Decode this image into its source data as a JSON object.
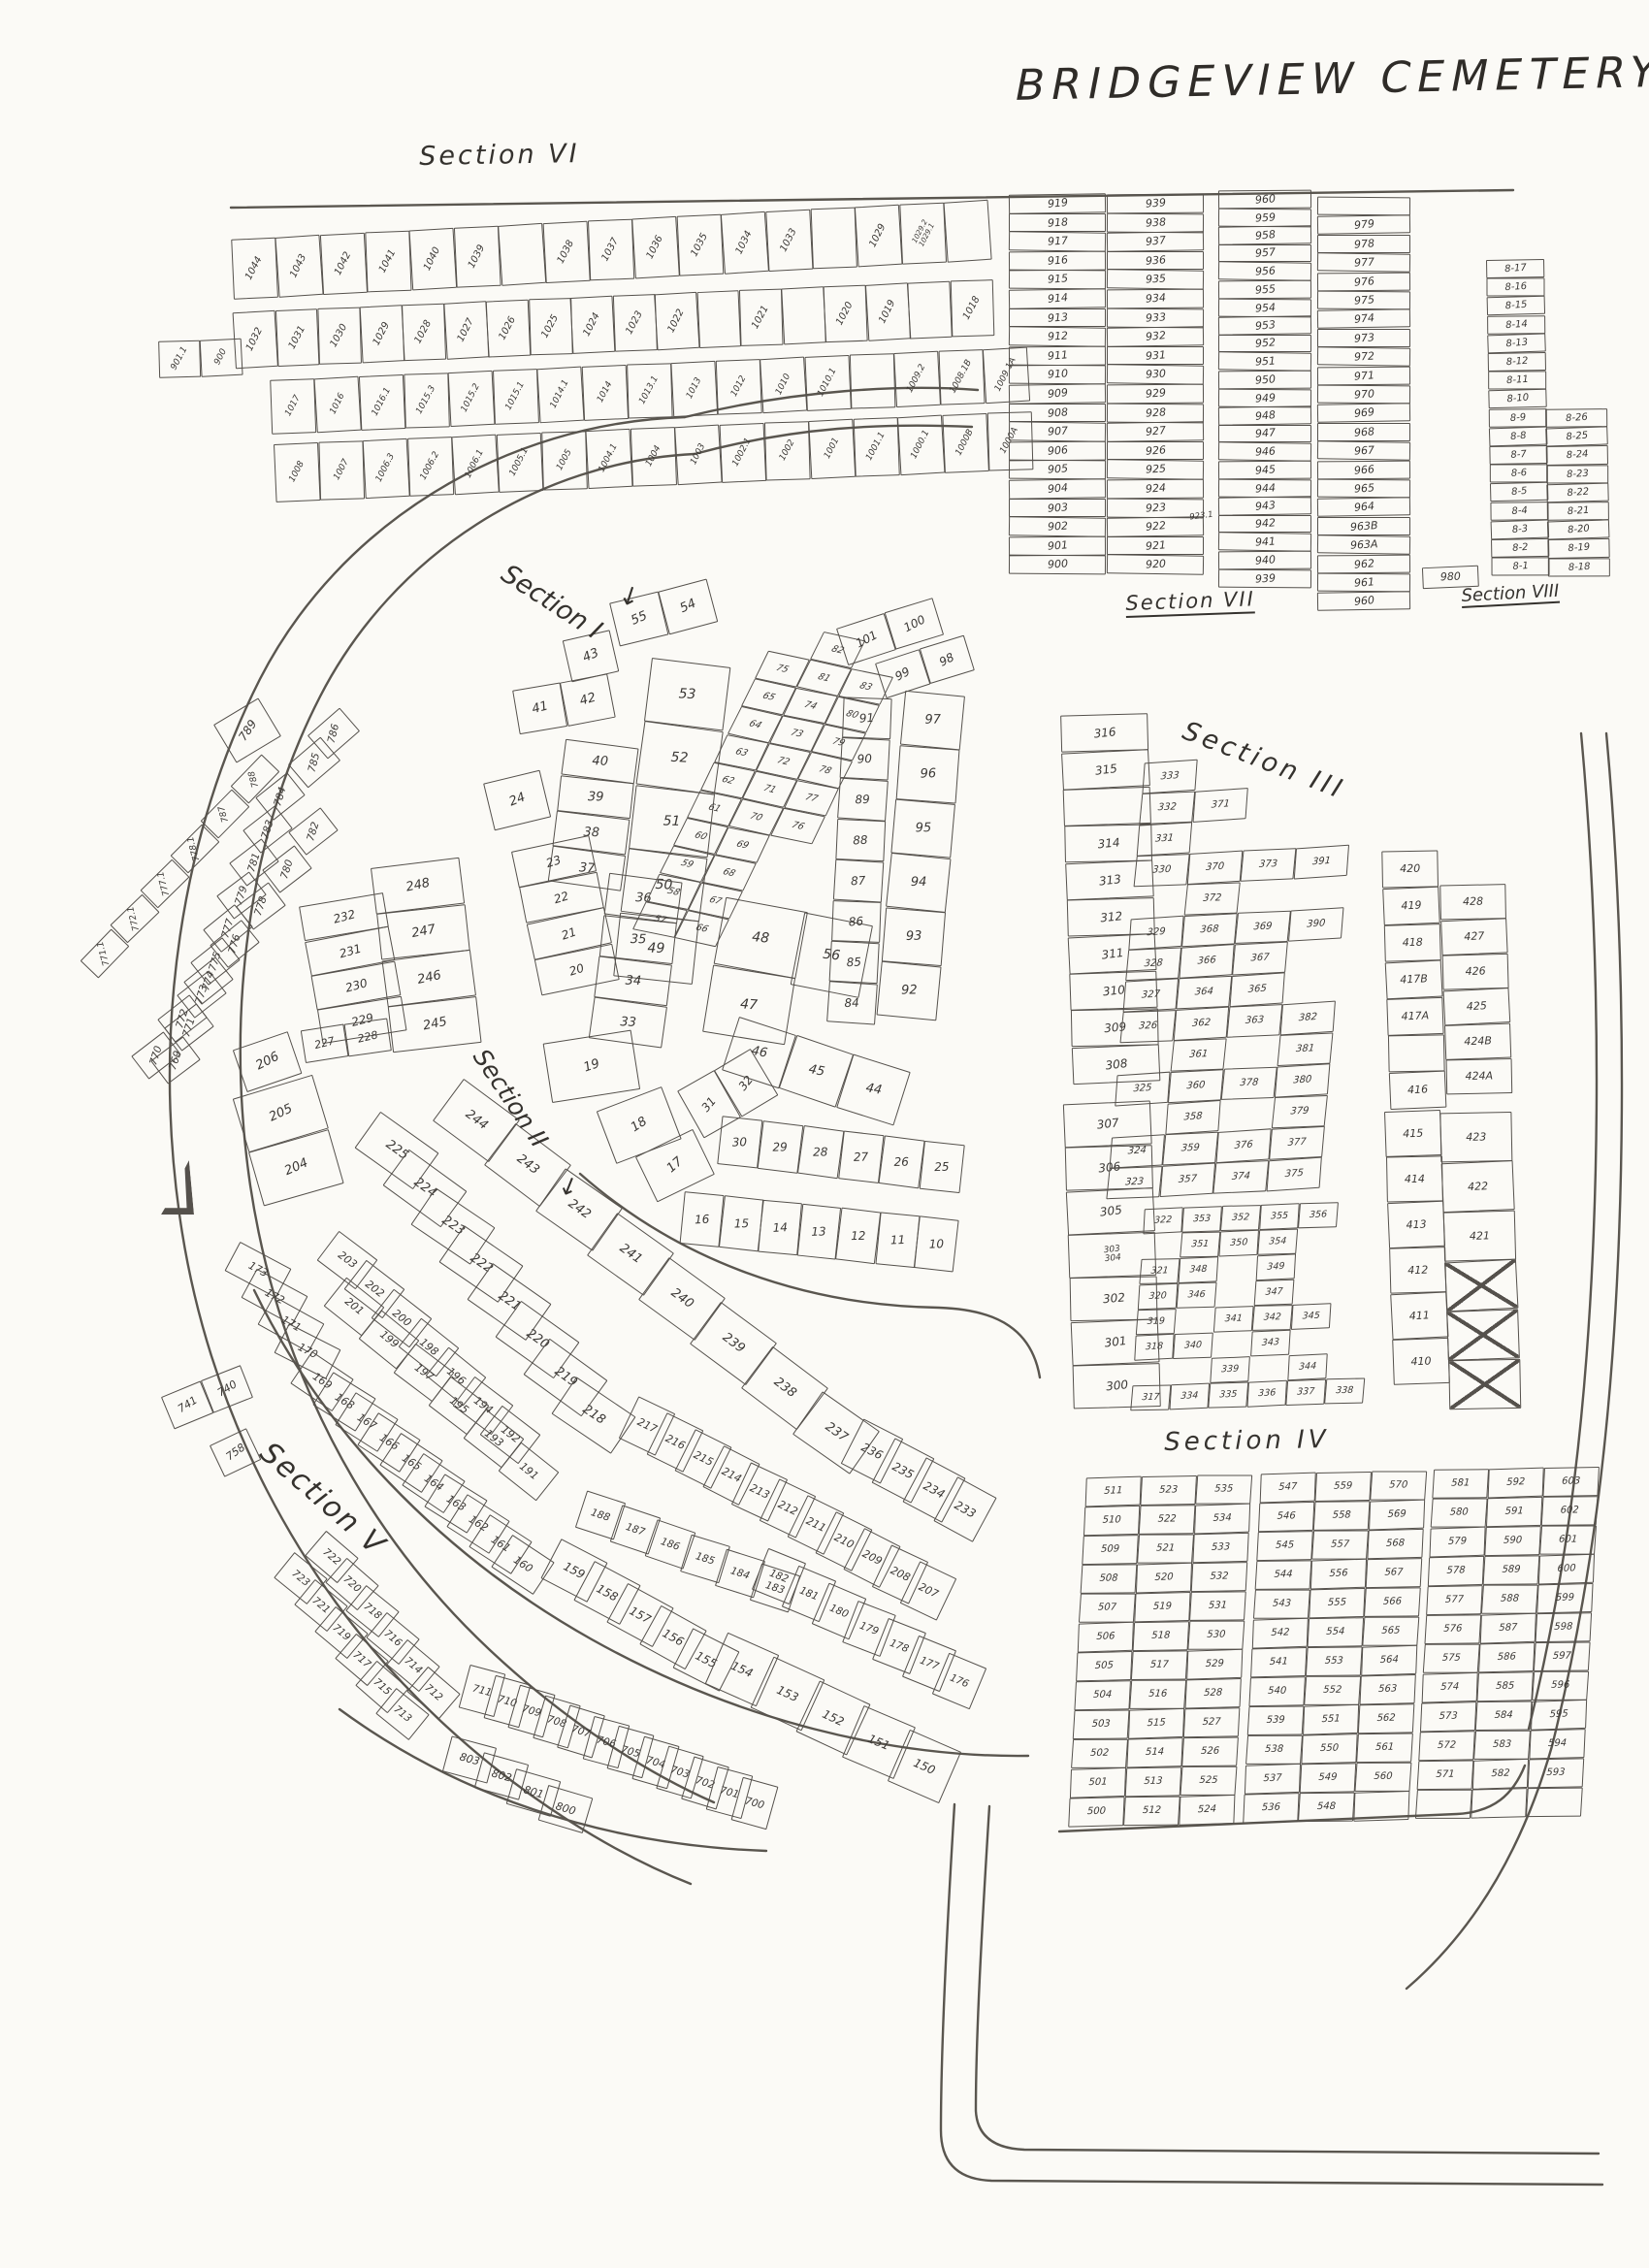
{
  "title": "BRIDGEVIEW CEMETERY",
  "icons": {
    "down_arrow": "↓"
  },
  "section_labels": {
    "s1": "Section I",
    "s2": "Section II",
    "s3": "Section III",
    "s4": "Section IV",
    "s5": "Section V",
    "s6": "Section VI",
    "s7": "Section VII",
    "s8": "Section VIII"
  },
  "plot_groups": {
    "s6r1": [
      "1044",
      "1043",
      "1042",
      "1041",
      "1040",
      "1039",
      "",
      "1038",
      "1037",
      "1036",
      "1035",
      "1034",
      "1033",
      "",
      "1029",
      "1029.2|1029.1",
      ""
    ],
    "s6r2": [
      "1032",
      "1031",
      "1030",
      "1029",
      "1028",
      "1027",
      "1026",
      "1025",
      "1024",
      "1023",
      "1022",
      "",
      "1021",
      "",
      "1020",
      "1019",
      "",
      "1018"
    ],
    "s6r3": [
      "1017",
      "1016",
      "1016.1",
      "1015.3",
      "1015.2",
      "1015.1",
      "1014.1",
      "1014",
      "1013.1",
      "1013",
      "1012",
      "1010",
      "1010.1",
      "",
      "1009.2",
      "1008.1B",
      "1009.1A"
    ],
    "s6r4": [
      "1008",
      "1007",
      "1006.3",
      "1006.2",
      "1006.1",
      "1005.1",
      "1005",
      "1004.1",
      "1004",
      "1003",
      "1002.1",
      "1002",
      "1001",
      "1001.1",
      "1000.1",
      "1000B",
      "1000A"
    ],
    "s6box": [
      "901.1",
      "900"
    ],
    "s7c1": [
      "919",
      "918",
      "917",
      "916",
      "915",
      "914",
      "913",
      "912",
      "911",
      "910",
      "909",
      "908",
      "907",
      "906",
      "905",
      "904",
      "903",
      "902",
      "901",
      "900"
    ],
    "s7c2": [
      "939",
      "938",
      "937",
      "936",
      "935",
      "934",
      "933",
      "932",
      "931",
      "930",
      "929",
      "928",
      "927",
      "926",
      "925",
      "924",
      "923",
      "922",
      "921",
      "920"
    ],
    "s7c3": [
      "960",
      "959",
      "958",
      "957",
      "956",
      "955",
      "954",
      "953",
      "952",
      "951",
      "950",
      "949",
      "948",
      "947",
      "946",
      "945",
      "944",
      "943",
      "942",
      "941",
      "940",
      "939"
    ],
    "s7c4": [
      "",
      "979",
      "978",
      "977",
      "976",
      "975",
      "974",
      "973",
      "972",
      "971",
      "970",
      "969",
      "968",
      "967",
      "966",
      "965",
      "964",
      "963B",
      "963A",
      "962",
      "961",
      "960"
    ],
    "s7extra": [
      "980"
    ],
    "s7x9231": [
      "923.1"
    ],
    "s8c1": [
      "8-17",
      "8-16",
      "8-15",
      "8-14",
      "8-13",
      "8-12",
      "8-11",
      "8-10",
      "8-9",
      "8-8",
      "8-7",
      "8-6",
      "8-5",
      "8-4",
      "8-3",
      "8-2",
      "8-1"
    ],
    "s8c2": [
      "8-26",
      "8-25",
      "8-24",
      "8-23",
      "8-22",
      "8-21",
      "8-20",
      "8-19",
      "8-18"
    ],
    "s1a": [
      "55",
      "54"
    ],
    "s1b": [
      "43"
    ],
    "s1c": [
      "41",
      "42"
    ],
    "s1d": [
      "53",
      "52",
      "51",
      "50",
      "49"
    ],
    "s1e": [
      "40",
      "39",
      "38",
      "37"
    ],
    "s1f": [
      "36",
      "35",
      "34",
      "33"
    ],
    "s1g": [
      "24"
    ],
    "s1h": [
      "23",
      "22",
      "21",
      "20"
    ],
    "s1i": [
      "19"
    ],
    "s1j": [
      "18"
    ],
    "s1k": [
      "17"
    ],
    "s1arcN": [
      "16",
      "15",
      "14",
      "13",
      "12",
      "11",
      "10"
    ],
    "s1arcS": [
      "30",
      "29",
      "28",
      "27",
      "26",
      "25"
    ],
    "s1arc31": [
      "31",
      "32"
    ],
    "s1arc46": [
      "46",
      "45",
      "44"
    ],
    "s1p48": [
      "48",
      "47"
    ],
    "s1p56": [
      "56"
    ],
    "s1grid": [
      "",
      "82",
      "",
      "75",
      "81",
      "83",
      "65",
      "74",
      "80",
      "64",
      "73",
      "79",
      "63",
      "72",
      "78",
      "62",
      "71",
      "77",
      "61",
      "70",
      "76",
      "60",
      "69",
      "",
      "59",
      "68",
      "",
      "58",
      "67",
      "",
      "57",
      "66",
      ""
    ],
    "s1colOuter": [
      "97",
      "96",
      "95",
      "94",
      "93",
      "92"
    ],
    "s1colInner": [
      "91",
      "90",
      "89",
      "88",
      "87",
      "86",
      "85",
      "84"
    ],
    "s1top100": [
      "101",
      "100"
    ],
    "s1top98": [
      "99",
      "98"
    ],
    "farc789": [
      "789"
    ],
    "farcTop": [
      "786",
      "785"
    ],
    "farcA": [
      "784",
      "783",
      "781",
      "779",
      "777",
      "775",
      "773",
      "771",
      "769"
    ],
    "farcB": [
      "782",
      "780",
      "778",
      "776",
      "774",
      "772",
      "770"
    ],
    "farcOut": [
      "788",
      "787",
      "778.1",
      "777.1",
      "772.1",
      "771.1"
    ],
    "s2wedge": [
      "232",
      "231",
      "230",
      "229"
    ],
    "s2p227": [
      "227",
      "228"
    ],
    "s2leftOuter": [
      "248",
      "247",
      "246",
      "245"
    ],
    "s2c206": [
      "206"
    ],
    "s2c205": [
      "205",
      "204"
    ],
    "s2diag225": [
      "225",
      "224",
      "223",
      "222",
      "221",
      "220",
      "219",
      "218"
    ],
    "s2dA": [
      "203",
      "202",
      "200",
      "198",
      "196",
      "194",
      "192"
    ],
    "s2dB": [
      "201",
      "199",
      "197",
      "195",
      "193",
      "191"
    ],
    "s2rBc": [
      "217",
      "216",
      "215",
      "214",
      "213",
      "212",
      "211",
      "210",
      "209",
      "208",
      "207"
    ],
    "s2c244": [
      "244",
      "243",
      "242",
      "241",
      "240",
      "239",
      "238",
      "237"
    ],
    "s2tail": [
      "236",
      "235",
      "234",
      "233"
    ],
    "s5arc1": [
      "173",
      "172",
      "171",
      "170"
    ],
    "s5arc2": [
      "169",
      "168",
      "167",
      "166",
      "165",
      "164",
      "163",
      "162",
      "161",
      "160"
    ],
    "s5arc3": [
      "159",
      "158",
      "157",
      "156",
      "155"
    ],
    "s5arc4": [
      "154",
      "153",
      "152",
      "151",
      "150"
    ],
    "s5g18a": [
      "188",
      "187",
      "186",
      "185",
      "184",
      "183"
    ],
    "s5g18b": [
      "182",
      "181",
      "180",
      "179",
      "178",
      "177",
      "176"
    ],
    "s5pairsA": [
      "722",
      "720",
      "718",
      "716",
      "714",
      "712"
    ],
    "s5pairsB": [
      "723",
      "721",
      "719",
      "717",
      "715",
      "713"
    ],
    "s5g700": [
      "711",
      "710",
      "709",
      "708",
      "707",
      "706",
      "705",
      "704",
      "703",
      "702",
      "701",
      "700"
    ],
    "s5g800": [
      "803",
      "802",
      "801",
      "800"
    ],
    "s5g74x": [
      "741",
      "740"
    ],
    "s5g758": [
      "758"
    ],
    "s3colTL": [
      "316",
      "315",
      "",
      "314",
      "313",
      "312",
      "311",
      "310",
      "309",
      "308"
    ],
    "s3colBL": [
      "307",
      "306",
      "305",
      "303|304",
      "302",
      "301",
      "300"
    ],
    "s3gridTop": [
      "333",
      "",
      "",
      "",
      "332",
      "371",
      "",
      "",
      "331",
      "",
      "",
      "",
      "330",
      "370",
      "373",
      "391",
      "",
      "372",
      "",
      "",
      "329",
      "368",
      "369",
      "390",
      "328",
      "366",
      "367",
      "",
      "327",
      "364",
      "365",
      "",
      "326",
      "362",
      "363",
      "382",
      "",
      "361",
      "",
      "381",
      "325",
      "360",
      "378",
      "380",
      "",
      "358",
      "",
      "379",
      "324",
      "359",
      "376",
      "377",
      "323",
      "357",
      "374",
      "375"
    ],
    "s3gridBot": [
      "322",
      "353",
      "352",
      "355",
      "356",
      "",
      "",
      "351",
      "350",
      "354",
      "",
      "",
      "321",
      "348",
      "",
      "349",
      "",
      "",
      "320",
      "346",
      "",
      "347",
      "",
      "",
      "319",
      "",
      "341",
      "342",
      "345",
      "",
      "318",
      "340",
      "",
      "343",
      "",
      "",
      "",
      "",
      "339",
      "",
      "344",
      "",
      "317",
      "334",
      "335",
      "336",
      "337",
      "338"
    ],
    "s3colR1": [
      "420",
      "419",
      "418",
      "417B",
      "417A",
      "",
      "416"
    ],
    "s3colR1b": [
      "415",
      "414",
      "413",
      "412",
      "411",
      "410"
    ],
    "s3colR2": [
      "428",
      "427",
      "426",
      "425",
      "424B",
      "424A"
    ],
    "s3colR2b": [
      "423",
      "422",
      "421",
      "",
      "",
      ""
    ],
    "s4b1": [
      "511",
      "523",
      "535",
      "510",
      "522",
      "534",
      "509",
      "521",
      "533",
      "508",
      "520",
      "532",
      "507",
      "519",
      "531",
      "506",
      "518",
      "530",
      "505",
      "517",
      "529",
      "504",
      "516",
      "528",
      "503",
      "515",
      "527",
      "502",
      "514",
      "526",
      "501",
      "513",
      "525",
      "500",
      "512",
      "524"
    ],
    "s4b2": [
      "547",
      "559",
      "570",
      "546",
      "558",
      "569",
      "545",
      "557",
      "568",
      "544",
      "556",
      "567",
      "543",
      "555",
      "566",
      "542",
      "554",
      "565",
      "541",
      "553",
      "564",
      "540",
      "552",
      "563",
      "539",
      "551",
      "562",
      "538",
      "550",
      "561",
      "537",
      "549",
      "560",
      "536",
      "548",
      ""
    ],
    "s4b3": [
      "581",
      "592",
      "603",
      "580",
      "591",
      "602",
      "579",
      "590",
      "601",
      "578",
      "589",
      "600",
      "577",
      "588",
      "599",
      "576",
      "587",
      "598",
      "575",
      "586",
      "597",
      "574",
      "585",
      "596",
      "573",
      "584",
      "595",
      "572",
      "583",
      "594",
      "571",
      "582",
      "593",
      "",
      "",
      ""
    ]
  }
}
